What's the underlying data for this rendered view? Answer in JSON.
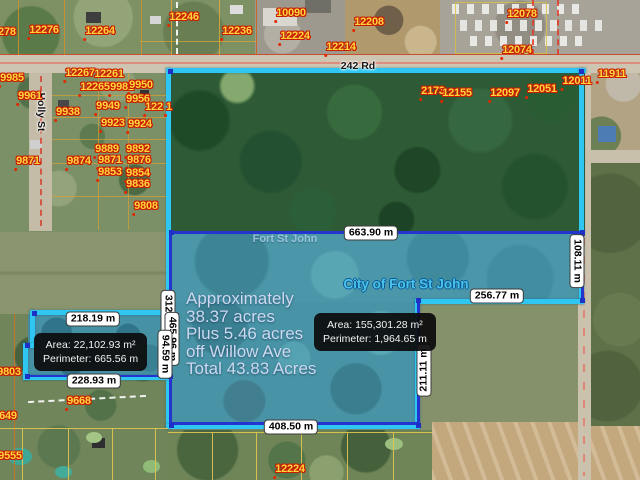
{
  "roads": {
    "main": "242 Rd",
    "left_street": "Holly St"
  },
  "place_label": "Fort St John",
  "city_label": "City of Fort St John",
  "annotation": {
    "lines": [
      "Approximately",
      "38.37 acres",
      "Plus 5.46 acres",
      "off Willow Ave",
      "Total 43.83 Acres"
    ]
  },
  "info_boxes": [
    {
      "area": "Area: 22,102.93 m²",
      "perimeter": "Perimeter: 665.56 m"
    },
    {
      "area": "Area: 155,301.28 m²",
      "perimeter": "Perimeter: 1,964.65 m"
    }
  ],
  "measurements": {
    "horizontal": [
      "663.90 m",
      "218.19 m",
      "228.93 m",
      "256.77 m",
      "408.50 m"
    ],
    "vertical": [
      "108.11 m",
      "211.11 m",
      "312.00 m",
      "465.96 m",
      "94.59 m"
    ]
  },
  "parcel_labels": [
    "12278",
    "12276",
    "12264",
    "12246",
    "12236",
    "10090",
    "12224",
    "12208",
    "12214",
    "12078",
    "12074",
    "2173",
    "12155",
    "12097",
    "12051",
    "12011",
    "11911",
    "9985",
    "12267",
    "12261",
    "12265",
    "9981",
    "9950",
    "9961",
    "9956",
    "122",
    "1",
    "9938",
    "9949",
    "9923",
    "9924",
    "9889",
    "9892",
    "9871",
    "9874",
    "9871",
    "9876",
    "9853",
    "9854",
    "9836",
    "9808",
    "9668",
    "9803",
    "9649",
    "9555",
    "12224"
  ],
  "colors": {
    "boundary_cyan": "#2fc7f1",
    "measure_navy": "#2334cf",
    "parcel_label_yellow": "#ffd43c",
    "parcel_label_outline": "#c81e00",
    "city_label_cyan": "#49c3e8",
    "city_fill_teal": "#4b97a9",
    "forest_green": "#2e5b35"
  }
}
